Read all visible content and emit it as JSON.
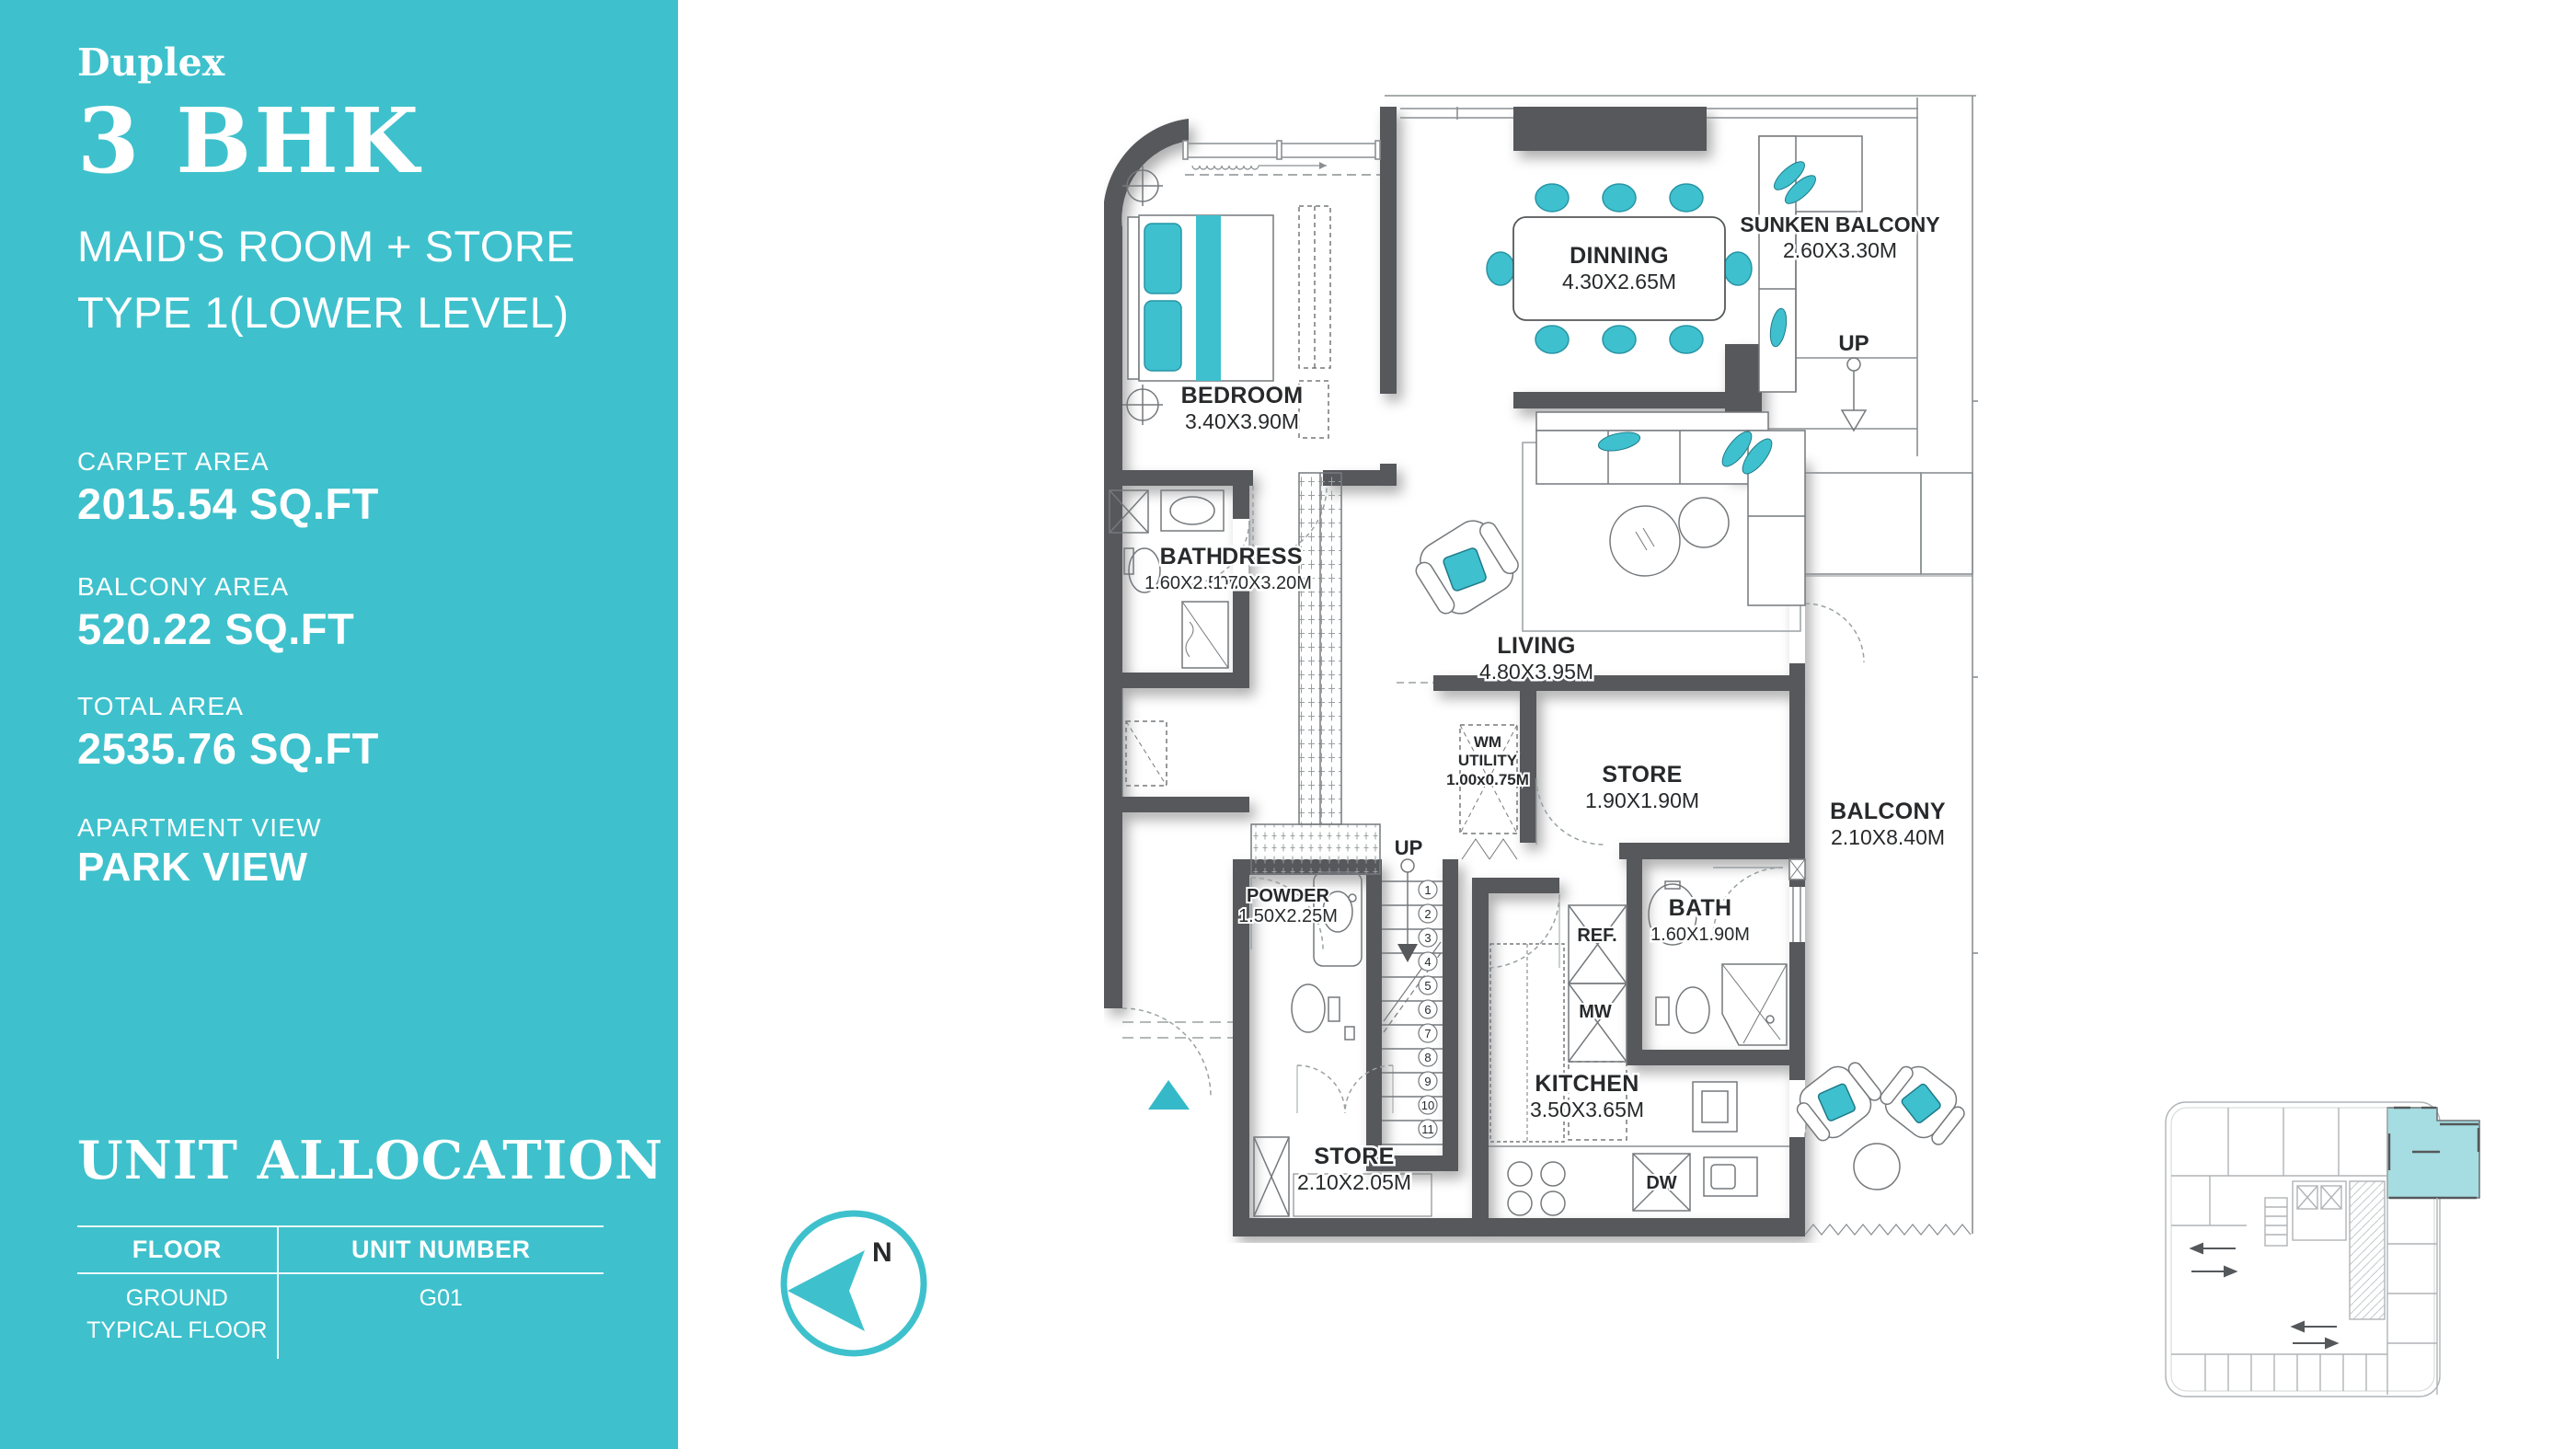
{
  "colors": {
    "accent_teal": "#3EC1CC",
    "furniture_teal": "#3FC0CE",
    "wall_gray": "#57585B",
    "keyplan_highlight": "#A5DDE2"
  },
  "sidebar": {
    "program": "Duplex",
    "title": "3 BHK",
    "subtitle1": "MAID'S ROOM + STORE",
    "subtitle2": "TYPE 1(LOWER LEVEL)",
    "stats": [
      {
        "label": "CARPET AREA",
        "value": "2015.54 SQ.FT"
      },
      {
        "label": "BALCONY AREA",
        "value": "520.22 SQ.FT"
      },
      {
        "label": "TOTAL AREA",
        "value": "2535.76 SQ.FT"
      },
      {
        "label": "APARTMENT VIEW",
        "value": "PARK VIEW"
      }
    ],
    "allocation": {
      "title": "UNIT ALLOCATION",
      "col1": "FLOOR",
      "col2": "UNIT NUMBER",
      "row_floor_line1": "GROUND",
      "row_floor_line2": "TYPICAL FLOOR",
      "row_unit": "G01"
    }
  },
  "compass": {
    "north_label": "N"
  },
  "floorplan": {
    "rooms": [
      {
        "name": "BEDROOM",
        "dim": "3.40X3.90M"
      },
      {
        "name": "DINNING",
        "dim": "4.30X2.65M"
      },
      {
        "name": "SUNKEN BALCONY",
        "dim": "2.60X3.30M"
      },
      {
        "name": "BATH",
        "dim": "1.60X2.50M"
      },
      {
        "name": "DRESS",
        "dim": "1.70X3.20M"
      },
      {
        "name": "LIVING",
        "dim": "4.80X3.95M"
      },
      {
        "name_line1": "WM",
        "name_line2": "UTILITY",
        "name": "WM UTILITY",
        "dim": "1.00x0.75M"
      },
      {
        "name": "STORE",
        "dim": "1.90X1.90M"
      },
      {
        "name": "BALCONY",
        "dim": "2.10X8.40M"
      },
      {
        "name": "BATH",
        "dim": "1.60X1.90M"
      },
      {
        "name": "POWDER",
        "dim": "1.50X2.25M"
      },
      {
        "name": "STORE",
        "dim": "2.10X2.05M"
      },
      {
        "name": "KITCHEN",
        "dim": "3.50X3.65M"
      }
    ],
    "labels": {
      "up_upper": "UP",
      "up_stairs": "UP",
      "ref": "REF.",
      "mw": "MW",
      "dw": "DW"
    },
    "stair_numbers": [
      "1",
      "2",
      "3",
      "4",
      "5",
      "6",
      "7",
      "8",
      "9",
      "10",
      "11"
    ]
  }
}
